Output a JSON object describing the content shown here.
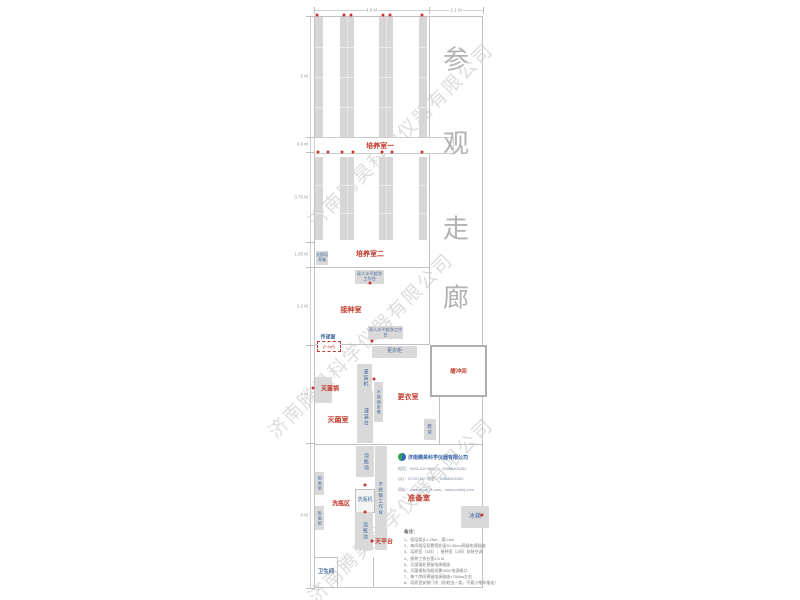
{
  "colors": {
    "red": "#c0392b",
    "blue": "#44699e",
    "rack_fill": "#d6d6d6",
    "wall": "#c2c2c2",
    "dim_text": "#999999",
    "corridor_text": "#b2b2b2",
    "watermark": "rgba(150,150,150,0.33)",
    "dot": "#cc3333"
  },
  "watermark": {
    "text": "济南腾昊科学仪器有限公司",
    "instances": [
      {
        "x": 400,
        "y": 135,
        "rot": -45
      },
      {
        "x": 360,
        "y": 345,
        "rot": -45
      },
      {
        "x": 400,
        "y": 510,
        "rot": -45
      }
    ]
  },
  "corridor": {
    "label": "参观走廊",
    "chars": [
      {
        "ch": "参",
        "x": 456,
        "y": 58
      },
      {
        "ch": "观",
        "x": 456,
        "y": 142
      },
      {
        "ch": "走",
        "x": 456,
        "y": 227
      },
      {
        "ch": "廊",
        "x": 456,
        "y": 296
      }
    ]
  },
  "dimensions": {
    "top": [
      {
        "label": "4.8 M",
        "x1": 314,
        "x2": 429,
        "y": 10
      },
      {
        "label": "2.1 M",
        "x1": 429,
        "x2": 483,
        "y": 10
      }
    ],
    "left": [
      {
        "label": "5 M",
        "y": 76
      },
      {
        "label": "0.6 M",
        "y": 144
      },
      {
        "label": "3.75 M",
        "y": 197
      },
      {
        "label": "1.05 M",
        "y": 254
      },
      {
        "label": "3.2 M",
        "y": 306
      },
      {
        "label": "4 M",
        "y": 394
      },
      {
        "label": "6 M",
        "y": 515
      }
    ],
    "left_ticks": [
      16,
      137,
      152,
      242,
      267,
      345,
      443,
      588
    ]
  },
  "walls": [
    {
      "name": "wall-outer-top",
      "x": 314,
      "y": 16,
      "w": 169,
      "h": 1
    },
    {
      "name": "wall-outer-bottom",
      "x": 314,
      "y": 587,
      "w": 169,
      "h": 1
    },
    {
      "name": "wall-outer-left",
      "x": 314,
      "y": 16,
      "w": 1,
      "h": 572
    },
    {
      "name": "wall-outer-right",
      "x": 482,
      "y": 16,
      "w": 1,
      "h": 572
    },
    {
      "name": "wall-corridor",
      "x": 429,
      "y": 16,
      "w": 1,
      "h": 329
    },
    {
      "name": "wall-culture2-bottom",
      "x": 314,
      "y": 267,
      "w": 116,
      "h": 1
    },
    {
      "name": "wall-inoculation-bottom",
      "x": 314,
      "y": 344,
      "w": 116,
      "h": 1
    },
    {
      "name": "wall-prep-top",
      "x": 314,
      "y": 444,
      "w": 169,
      "h": 1
    },
    {
      "name": "wall-dressing-right",
      "x": 439,
      "y": 393,
      "w": 1,
      "h": 52
    },
    {
      "name": "wall-dressing-top",
      "x": 439,
      "y": 396,
      "w": 44,
      "h": 1
    },
    {
      "name": "wall-toilet-top",
      "x": 314,
      "y": 557,
      "w": 24,
      "h": 1
    },
    {
      "name": "wall-toilet-right",
      "x": 337,
      "y": 557,
      "w": 1,
      "h": 31
    },
    {
      "name": "wall-balance-side",
      "x": 373,
      "y": 557,
      "w": 1,
      "h": 31
    }
  ],
  "racks": {
    "columns": [
      {
        "x": 315,
        "w": 8,
        "double": false
      },
      {
        "x": 340,
        "w": 14,
        "double": true
      },
      {
        "x": 379,
        "w": 14,
        "double": true
      },
      {
        "x": 419,
        "w": 8,
        "double": false
      }
    ],
    "sections": [
      {
        "y": 17,
        "h": 120,
        "dividers": [
          30,
          60,
          90
        ]
      },
      {
        "y": 157,
        "h": 83,
        "dividers": [
          28,
          56
        ]
      }
    ]
  },
  "band": {
    "label": "培养室一",
    "x": 314,
    "y": 137,
    "w": 138,
    "h": 15
  },
  "room_labels": [
    {
      "name": "room-label-culture-2",
      "text": "培养室二",
      "x": 370,
      "y": 254,
      "size": 7,
      "color": "red"
    },
    {
      "name": "room-label-inoculation",
      "text": "接种室",
      "x": 351,
      "y": 310,
      "size": 7,
      "color": "red"
    },
    {
      "name": "label-autoclave",
      "text": "灭菌锅",
      "x": 330,
      "y": 388,
      "size": 6,
      "color": "red"
    },
    {
      "name": "room-label-sterilization",
      "text": "灭菌室",
      "x": 338,
      "y": 420,
      "size": 7,
      "color": "red"
    },
    {
      "name": "room-label-dressing",
      "text": "更衣室",
      "x": 408,
      "y": 397,
      "size": 7,
      "color": "red"
    },
    {
      "name": "room-label-washing-area",
      "text": "洗瓶区",
      "x": 341,
      "y": 503,
      "size": 6,
      "color": "red"
    },
    {
      "name": "label-balance-table",
      "text": "天平台",
      "x": 384,
      "y": 541,
      "size": 6,
      "color": "red"
    },
    {
      "name": "room-label-prep",
      "text": "准备室",
      "x": 419,
      "y": 498,
      "size": 7.5,
      "color": "red"
    },
    {
      "name": "label-pass-window",
      "text": "传递窗",
      "x": 328,
      "y": 337,
      "size": 5,
      "color": "blue"
    },
    {
      "name": "room-label-toilet",
      "text": "卫生间",
      "x": 326,
      "y": 571,
      "size": 5.5,
      "color": "blue"
    }
  ],
  "equipment": [
    {
      "name": "equip-light-incubator",
      "label": "光照培养箱",
      "x": 316,
      "y": 251,
      "w": 12,
      "h": 14,
      "size": 4,
      "wrap": true
    },
    {
      "name": "equip-clean-bench-1",
      "label": "双人水平超净工作台",
      "x": 355,
      "y": 270,
      "w": 29,
      "h": 14,
      "size": 4.2,
      "wrap": true
    },
    {
      "name": "equip-clean-bench-2",
      "label": "双人水平超净工作台",
      "x": 368,
      "y": 326,
      "w": 35,
      "h": 13,
      "size": 4.2,
      "wrap": true
    },
    {
      "name": "equip-wardrobe",
      "label": "更衣柜",
      "x": 372,
      "y": 346,
      "w": 45,
      "h": 12,
      "size": 5
    },
    {
      "name": "equip-autoclave-box",
      "label": "",
      "x": 315,
      "y": 377,
      "w": 17,
      "h": 26
    },
    {
      "name": "equip-filling-machine",
      "label": "灌装机",
      "x": 357,
      "y": 364,
      "w": 15,
      "h": 27,
      "vertical": true,
      "size": 5
    },
    {
      "name": "equip-filling-table",
      "label": "灌装台",
      "x": 357,
      "y": 391,
      "w": 16,
      "h": 52,
      "vertical": true,
      "size": 5
    },
    {
      "name": "equip-steel-bench",
      "label": "不锈钢条凳",
      "x": 374,
      "y": 382,
      "w": 9,
      "h": 40,
      "vertical": true,
      "size": 4
    },
    {
      "name": "equip-shoe-rack",
      "label": "鞋架",
      "x": 424,
      "y": 419,
      "w": 12,
      "h": 21,
      "vertical": true,
      "size": 4.5
    },
    {
      "name": "equip-soak-pool-1",
      "label": "泡瓶池",
      "x": 356,
      "y": 446,
      "w": 18,
      "h": 31,
      "vertical": true,
      "size": 5
    },
    {
      "name": "equip-steel-worktable",
      "label": "不锈钢工作台",
      "x": 375,
      "y": 446,
      "w": 12,
      "h": 104,
      "vertical": true,
      "size": 4.5
    },
    {
      "name": "equip-bottle-washer",
      "label": "洗瓶机",
      "x": 355,
      "y": 489,
      "w": 18,
      "h": 22,
      "size": 5,
      "light": true
    },
    {
      "name": "equip-soak-pool-2",
      "label": "泡瓶池",
      "x": 355,
      "y": 512,
      "w": 18,
      "h": 38,
      "vertical": true,
      "size": 5
    },
    {
      "name": "equip-dry-rack-1",
      "label": "晾瓶架",
      "x": 315,
      "y": 472,
      "w": 9,
      "h": 23,
      "vertical": true,
      "size": 4
    },
    {
      "name": "equip-dry-rack-2",
      "label": "晾瓶架",
      "x": 315,
      "y": 506,
      "w": 9,
      "h": 24,
      "vertical": true,
      "size": 4
    },
    {
      "name": "equip-fridge",
      "label": "冰箱",
      "x": 461,
      "y": 506,
      "w": 28,
      "h": 22,
      "size": 6
    }
  ],
  "pass_window": {
    "label": "(0.4㎡)",
    "x": 317,
    "y": 341,
    "w": 22,
    "h": 9
  },
  "buffer_room": {
    "label": "缓冲间",
    "x": 430,
    "y": 345,
    "w": 53,
    "h": 48
  },
  "dots": [
    [
      317,
      15
    ],
    [
      344,
      15
    ],
    [
      351,
      15
    ],
    [
      383,
      15
    ],
    [
      390,
      15
    ],
    [
      422,
      15
    ],
    [
      318,
      152
    ],
    [
      328,
      152
    ],
    [
      342,
      152
    ],
    [
      353,
      152
    ],
    [
      382,
      152
    ],
    [
      392,
      152
    ],
    [
      422,
      152
    ],
    [
      370,
      283
    ],
    [
      372,
      341
    ],
    [
      313,
      388
    ],
    [
      374,
      379
    ],
    [
      365,
      485
    ],
    [
      365,
      512
    ],
    [
      372,
      541
    ],
    [
      482,
      515
    ]
  ],
  "company": {
    "name": "济南腾昊科学仪器有限公司",
    "lines": [
      "电话：0531-82749617，15866401052",
      "QQ：57437467    微信：15866401052",
      "网址：www.sype17.com，www.cmhkj.com"
    ]
  },
  "notes": {
    "title": "备注：",
    "items": [
      "1、组培架长1.25m，宽0.5m",
      "2、每间组培室靠墙处留30-35cm预留电源插座",
      "3、培养室（3间）、接种室（2间）安装空调",
      "4、接种工作台宽1.5 M",
      "5、灭菌锅处预留电源插座",
      "6、灭菌锅和洗瓶机需380V电源接口",
      "7、每个房间预留电源插座×750kw左右",
      "8、培养室安装门帘（防蚊虫一类，不要小推车推走）"
    ]
  }
}
